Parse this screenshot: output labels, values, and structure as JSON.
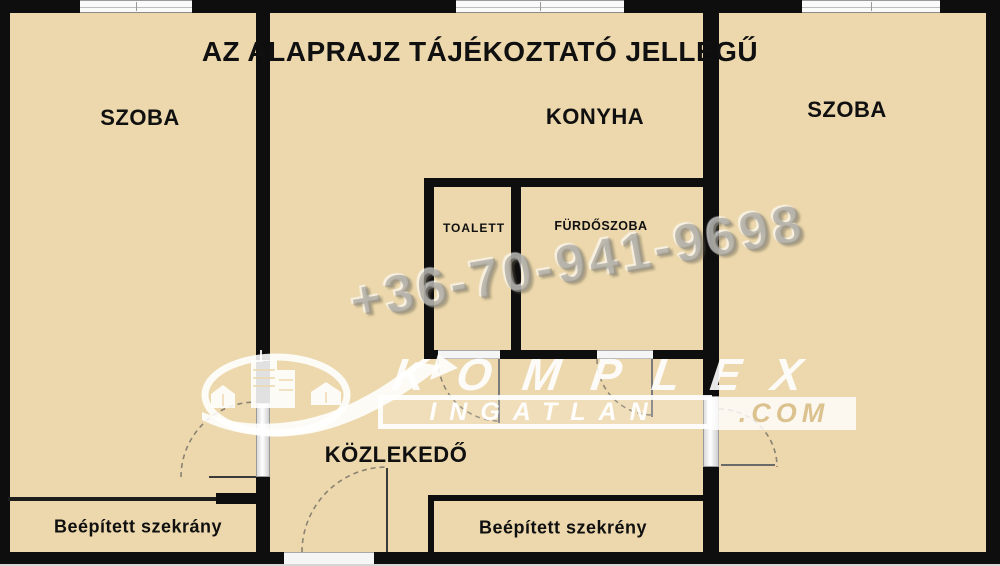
{
  "title": "AZ ALAPRAJZ TÁJÉKOZTATÓ JELLEGŰ",
  "rooms": {
    "szoba_left": "SZOBA",
    "konyha": "KONYHA",
    "szoba_right": "SZOBA",
    "toalett": "TOALETT",
    "furdoszoba": "FÜRDŐSZOBA",
    "kozlekedo": "KÖZLEKEDŐ",
    "wardrobe_left": "Beépített szekrány",
    "wardrobe_middle": "Beépített szekrény"
  },
  "watermark": {
    "phone": "+36-70-941-9698"
  },
  "logo": {
    "brand": "KOMPLEX",
    "line2": "INGATLAN",
    "tld": ".COM"
  },
  "icons": [
    "buildings-icon",
    "swoosh-arrow-icon"
  ],
  "colors": {
    "floor": "#ecd8ac",
    "wall": "#0e0e0e",
    "watermark_gray": "#96948e",
    "logo_white": "#ffffff",
    "com_text_tan": "#dbc28f"
  }
}
